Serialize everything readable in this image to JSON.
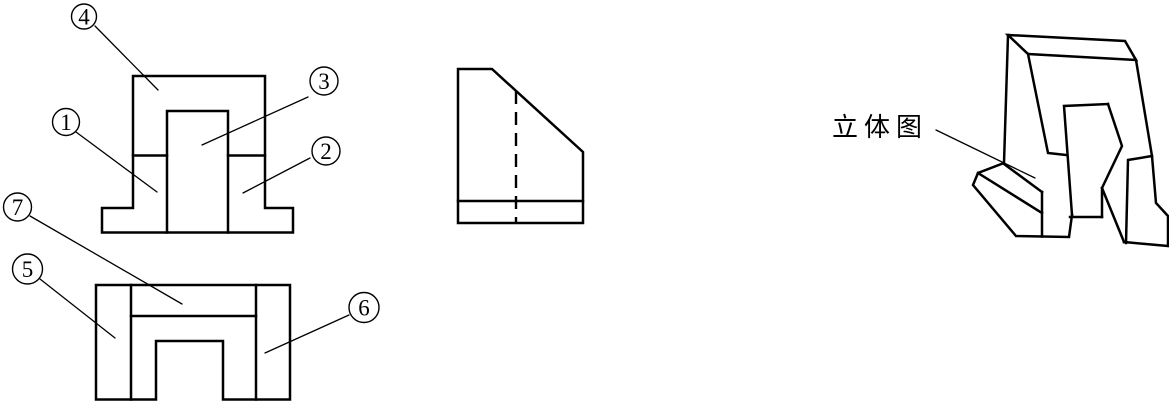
{
  "drawing": {
    "background_color": "#ffffff",
    "line_color": "#000000",
    "pictorial_caption": "立体图",
    "callouts": [
      {
        "number": "1"
      },
      {
        "number": "2"
      },
      {
        "number": "3"
      },
      {
        "number": "4"
      },
      {
        "number": "5"
      },
      {
        "number": "6"
      },
      {
        "number": "7"
      }
    ]
  }
}
